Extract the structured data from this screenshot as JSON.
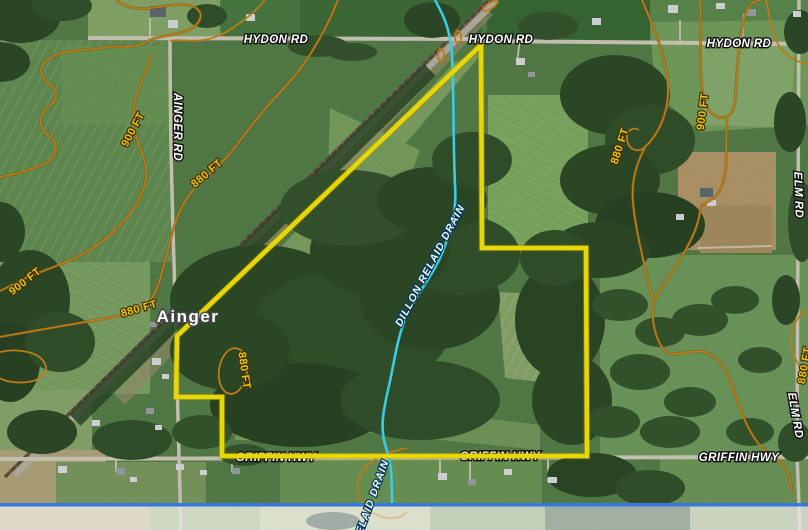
{
  "map": {
    "place": "Ainger",
    "road_labels": {
      "hydon_rd": "HYDON RD",
      "ainger_rd": "AINGER RD",
      "elm_rd": "ELM RD",
      "griffin_hwy": "GRIFFIN HWY"
    },
    "contour_labels": {
      "ft_900": "900 FT",
      "ft_880": "880 FT"
    },
    "drain_labels": {
      "full": "DILLON RELAID DRAIN",
      "partial": "RELAID DRAIN"
    },
    "colors": {
      "property_boundary": "#f6e50b",
      "drain": "#3fd9f2",
      "contour": "#c8841a",
      "contour_label_text": "#f5d313",
      "road_label_text": "#ffffff",
      "bottom_divider": "#3478e0"
    }
  }
}
